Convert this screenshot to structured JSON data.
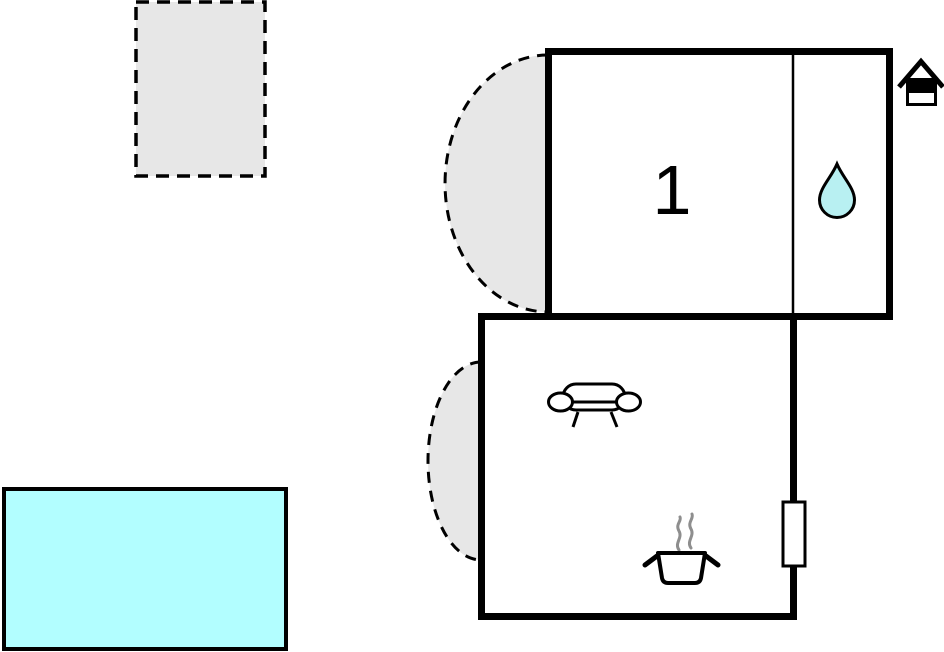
{
  "plan": {
    "room_label": "1",
    "colors": {
      "wall": "#000000",
      "area_fill": "#e7e7e7",
      "pool_fill": "#b2feff",
      "drop_fill": "#b8f0f2",
      "steam": "#8e8e8e",
      "background": "#ffffff"
    },
    "icons": [
      "house-icon",
      "water-drop-icon",
      "sofa-icon",
      "cooking-pot-icon",
      "radiator",
      "door-swing-arc"
    ]
  }
}
